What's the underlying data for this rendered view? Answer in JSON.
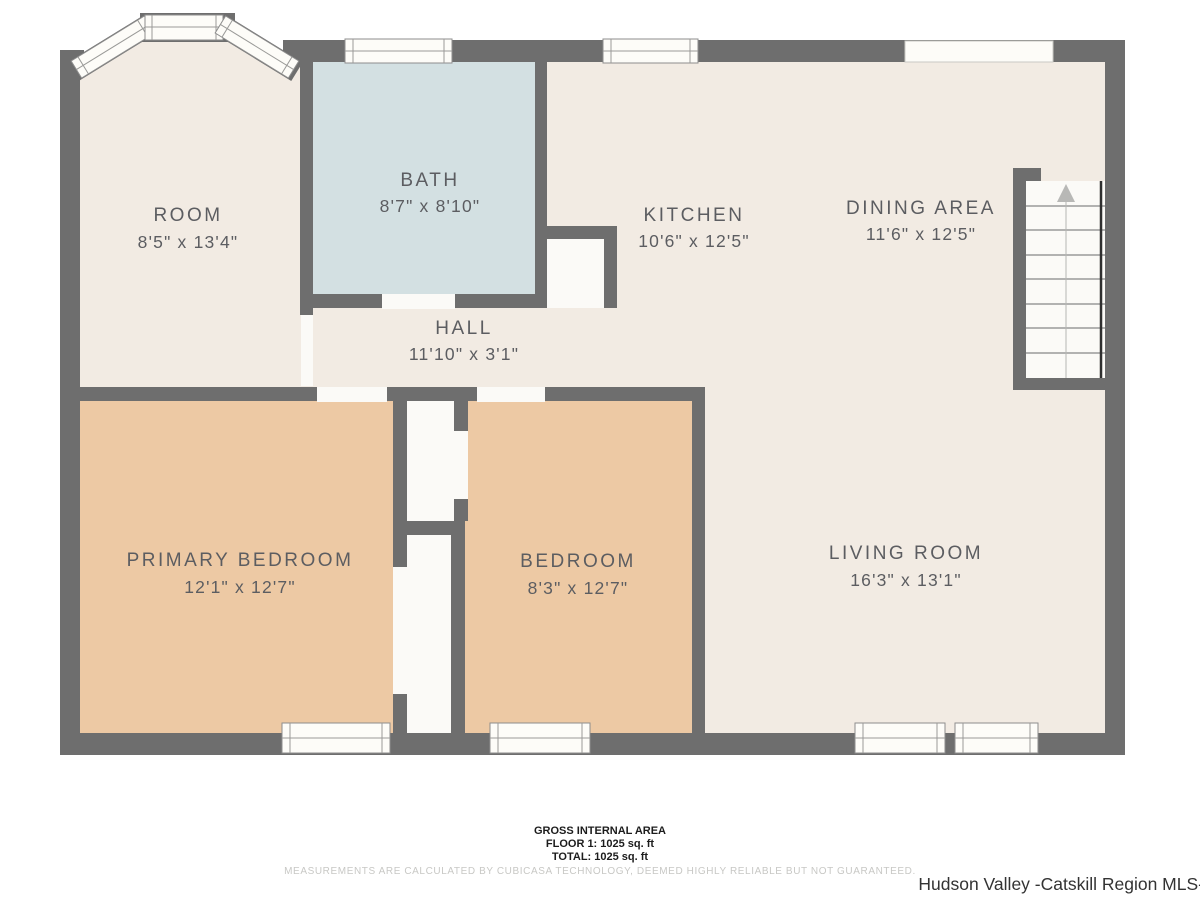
{
  "colors": {
    "wall": "#6e6e6e",
    "floor": "#f2ebe3",
    "bath_floor": "#d3e0e2",
    "bedroom_floor": "#edc9a4",
    "closet": "#fbfaf7",
    "window": "#fdfcf8",
    "label_text": "#5c5d61",
    "footer_text": "#1c1c1c",
    "disclaimer_text": "#c8c8c5",
    "watermark_text": "#333333"
  },
  "rooms": [
    {
      "id": "room",
      "name": "ROOM",
      "dims": "8'5\" x 13'4\""
    },
    {
      "id": "bath",
      "name": "BATH",
      "dims": "8'7\" x 8'10\""
    },
    {
      "id": "kitchen",
      "name": "KITCHEN",
      "dims": "10'6\" x 12'5\""
    },
    {
      "id": "dining-area",
      "name": "DINING AREA",
      "dims": "11'6\" x 12'5\""
    },
    {
      "id": "hall",
      "name": "HALL",
      "dims": "11'10\" x 3'1\""
    },
    {
      "id": "primary-bedroom",
      "name": "PRIMARY BEDROOM",
      "dims": "12'1\" x 12'7\""
    },
    {
      "id": "bedroom",
      "name": "BEDROOM",
      "dims": "8'3\" x 12'7\""
    },
    {
      "id": "living-room",
      "name": "LIVING ROOM",
      "dims": "16'3\" x 13'1\""
    }
  ],
  "footer": {
    "area_title": "GROSS INTERNAL AREA",
    "floor_line": "FLOOR 1: 1025 sq. ft",
    "total_line": "TOTAL: 1025 sq. ft",
    "disclaimer": "MEASUREMENTS ARE CALCULATED BY CUBICASA TECHNOLOGY, DEEMED HIGHLY RELIABLE BUT NOT GUARANTEED."
  },
  "watermark": "Hudson Valley -Catskill Region MLS-"
}
